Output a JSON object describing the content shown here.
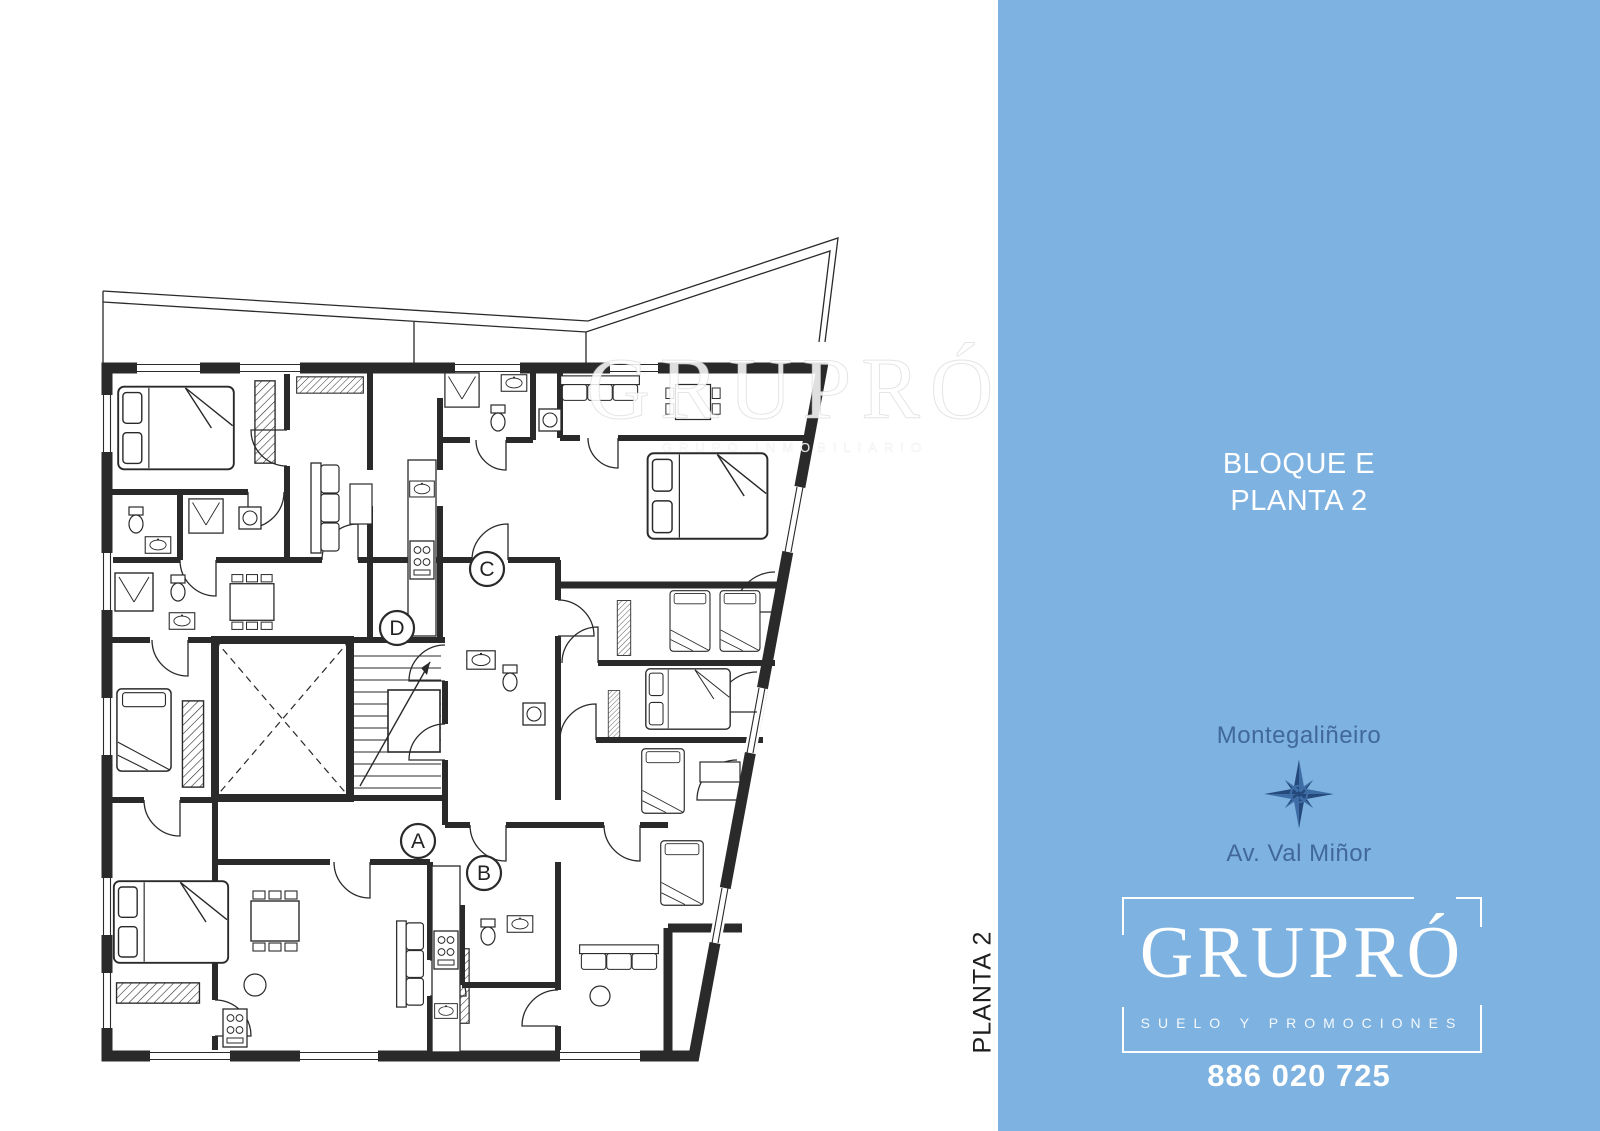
{
  "plan": {
    "side_label": "PLANTA 2",
    "watermark": {
      "title": "GRUPRÓ",
      "subtitle": "GRUPO INMOBILIARIO"
    },
    "units": [
      {
        "label": "A"
      },
      {
        "label": "B"
      },
      {
        "label": "C"
      },
      {
        "label": "D"
      }
    ]
  },
  "panel": {
    "title_line1": "BLOQUE E",
    "title_line2": "PLANTA 2",
    "location_top": "Montegaliñeiro",
    "location_bottom": "Av. Val Miñor",
    "logo": {
      "name": "GRUPRÓ",
      "tagline": "SUELO Y PROMOCIONES",
      "phone": "886 020 725"
    }
  },
  "colors": {
    "panel_bg": "#7eb2e0",
    "panel_text_blue": "#41689b",
    "compass_dark": "#24497a",
    "compass_light": "#3e6da5",
    "plan_ink": "#2a2a2a",
    "watermark": "#ffffff"
  }
}
